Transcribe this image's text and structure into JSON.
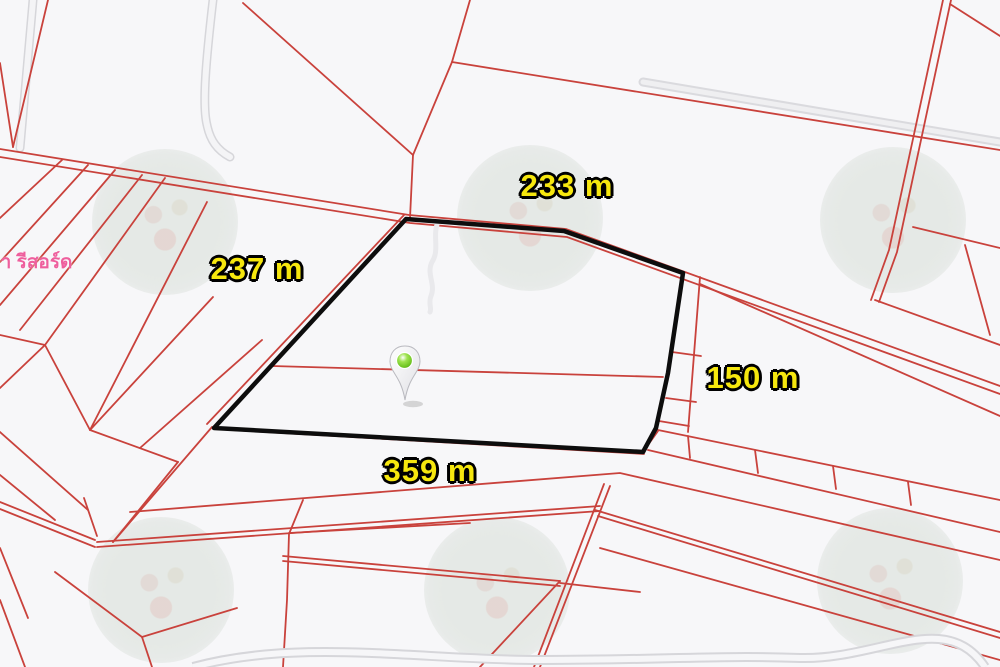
{
  "map": {
    "dimension_labels": [
      {
        "side": "top",
        "text": "233 m",
        "value_m": 233
      },
      {
        "side": "left",
        "text": "237 m",
        "value_m": 237
      },
      {
        "side": "right",
        "text": "150 m",
        "value_m": 150
      },
      {
        "side": "bottom",
        "text": "359 m",
        "value_m": 359
      }
    ],
    "place_label": {
      "text": "วา รีสอร์ด"
    },
    "highlighted_parcel": {
      "outline": "black",
      "side_lengths_m": {
        "top": 233,
        "left": 237,
        "right": 150,
        "bottom": 359
      }
    },
    "marker": {
      "type": "map-pin",
      "dot_color": "#7bd32b"
    }
  },
  "colors": {
    "background": "#f7f7f9",
    "parcel_line": "#c9423c",
    "highlight_outline": "#0d0d0d",
    "label_fill": "#f6e70e",
    "label_outline": "#000000",
    "place_text": "#ee5f9d"
  }
}
